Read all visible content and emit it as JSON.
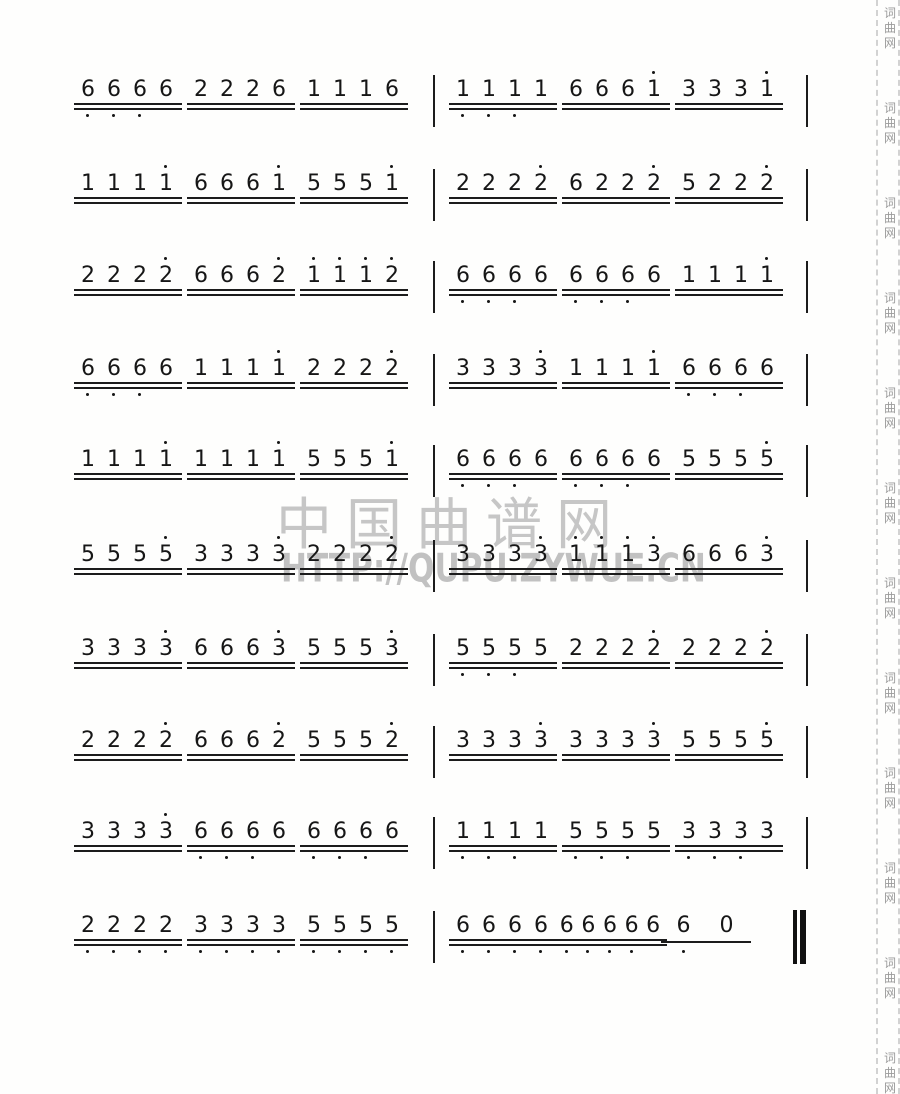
{
  "watermark": {
    "site_name": "中国曲谱网",
    "site_url": "HTTP://QUPU.ZYWUE.CN",
    "color": "#9a9a9a"
  },
  "side_strip": {
    "text": "词曲网",
    "repeat": 12
  },
  "score": {
    "notation_type": "jianpu-numbered-notation",
    "ink_color": "#1c1c1c",
    "rows": [
      {
        "cells": [
          {
            "t": "g",
            "n": "6666",
            "b": [
              0,
              1,
              2
            ]
          },
          {
            "t": "g",
            "n": "2226"
          },
          {
            "t": "g",
            "n": "1116"
          },
          {
            "t": "bar"
          },
          {
            "t": "g",
            "n": "1111",
            "b": [
              0,
              1,
              2
            ]
          },
          {
            "t": "g",
            "n": "6661",
            "a": [
              3
            ]
          },
          {
            "t": "g",
            "n": "3331",
            "a": [
              3
            ]
          },
          {
            "t": "bar"
          }
        ]
      },
      {
        "cells": [
          {
            "t": "g",
            "n": "1111",
            "a": [
              3
            ]
          },
          {
            "t": "g",
            "n": "6661",
            "a": [
              3
            ]
          },
          {
            "t": "g",
            "n": "5551",
            "a": [
              3
            ]
          },
          {
            "t": "bar"
          },
          {
            "t": "g",
            "n": "2222",
            "a": [
              3
            ]
          },
          {
            "t": "g",
            "n": "6222",
            "a": [
              3
            ]
          },
          {
            "t": "g",
            "n": "5222",
            "a": [
              3
            ]
          },
          {
            "t": "bar"
          }
        ]
      },
      {
        "cells": [
          {
            "t": "g",
            "n": "2222",
            "a": [
              3
            ]
          },
          {
            "t": "g",
            "n": "6662",
            "a": [
              3
            ]
          },
          {
            "t": "g",
            "n": "1112",
            "a": [
              0,
              1,
              2,
              3
            ]
          },
          {
            "t": "bar"
          },
          {
            "t": "g",
            "n": "6666",
            "b": [
              0,
              1,
              2
            ]
          },
          {
            "t": "g",
            "n": "6666",
            "b": [
              0,
              1,
              2
            ]
          },
          {
            "t": "g",
            "n": "1111",
            "a": [
              3
            ]
          },
          {
            "t": "bar"
          }
        ]
      },
      {
        "cells": [
          {
            "t": "g",
            "n": "6666",
            "b": [
              0,
              1,
              2
            ]
          },
          {
            "t": "g",
            "n": "1111",
            "a": [
              3
            ]
          },
          {
            "t": "g",
            "n": "2222",
            "a": [
              3
            ]
          },
          {
            "t": "bar"
          },
          {
            "t": "g",
            "n": "3333",
            "a": [
              3
            ]
          },
          {
            "t": "g",
            "n": "1111",
            "a": [
              3
            ]
          },
          {
            "t": "g",
            "n": "6666",
            "b": [
              0,
              1,
              2
            ]
          },
          {
            "t": "bar"
          }
        ]
      },
      {
        "cells": [
          {
            "t": "g",
            "n": "1111",
            "a": [
              3
            ]
          },
          {
            "t": "g",
            "n": "1111",
            "a": [
              3
            ]
          },
          {
            "t": "g",
            "n": "5551",
            "a": [
              3
            ]
          },
          {
            "t": "bar"
          },
          {
            "t": "g",
            "n": "6666",
            "b": [
              0,
              1,
              2
            ]
          },
          {
            "t": "g",
            "n": "6666",
            "b": [
              0,
              1,
              2
            ]
          },
          {
            "t": "g",
            "n": "5555",
            "a": [
              3
            ]
          },
          {
            "t": "bar"
          }
        ]
      },
      {
        "cells": [
          {
            "t": "g",
            "n": "5555",
            "a": [
              3
            ]
          },
          {
            "t": "g",
            "n": "3333",
            "a": [
              3
            ]
          },
          {
            "t": "g",
            "n": "2222",
            "a": [
              3
            ]
          },
          {
            "t": "bar"
          },
          {
            "t": "g",
            "n": "3333",
            "a": [
              3
            ]
          },
          {
            "t": "g",
            "n": "1113",
            "a": [
              0,
              1,
              2,
              3
            ]
          },
          {
            "t": "g",
            "n": "6663",
            "a": [
              3
            ]
          },
          {
            "t": "bar"
          }
        ]
      },
      {
        "cells": [
          {
            "t": "g",
            "n": "3333",
            "a": [
              3
            ]
          },
          {
            "t": "g",
            "n": "6663",
            "a": [
              3
            ]
          },
          {
            "t": "g",
            "n": "5553",
            "a": [
              3
            ]
          },
          {
            "t": "bar"
          },
          {
            "t": "g",
            "n": "5555",
            "b": [
              0,
              1,
              2
            ]
          },
          {
            "t": "g",
            "n": "2222",
            "a": [
              3
            ]
          },
          {
            "t": "g",
            "n": "2222",
            "a": [
              3
            ]
          },
          {
            "t": "bar"
          }
        ]
      },
      {
        "cells": [
          {
            "t": "g",
            "n": "2222",
            "a": [
              3
            ]
          },
          {
            "t": "g",
            "n": "6662",
            "a": [
              3
            ]
          },
          {
            "t": "g",
            "n": "5552",
            "a": [
              3
            ]
          },
          {
            "t": "bar"
          },
          {
            "t": "g",
            "n": "3333",
            "a": [
              3
            ]
          },
          {
            "t": "g",
            "n": "3333",
            "a": [
              3
            ]
          },
          {
            "t": "g",
            "n": "5555",
            "a": [
              3
            ]
          },
          {
            "t": "bar"
          }
        ]
      },
      {
        "cells": [
          {
            "t": "g",
            "n": "3333",
            "a": [
              3
            ]
          },
          {
            "t": "g",
            "n": "6666",
            "b": [
              0,
              1,
              2
            ]
          },
          {
            "t": "g",
            "n": "6666",
            "b": [
              0,
              1,
              2
            ]
          },
          {
            "t": "bar"
          },
          {
            "t": "g",
            "n": "1111",
            "b": [
              0,
              1,
              2
            ]
          },
          {
            "t": "g",
            "n": "5555",
            "b": [
              0,
              1,
              2
            ]
          },
          {
            "t": "g",
            "n": "3333",
            "b": [
              0,
              1,
              2
            ]
          },
          {
            "t": "bar"
          }
        ]
      },
      {
        "cells": [
          {
            "t": "g",
            "n": "2222",
            "b": [
              0,
              1,
              2,
              3
            ]
          },
          {
            "t": "g",
            "n": "3333",
            "b": [
              0,
              1,
              2,
              3
            ]
          },
          {
            "t": "g",
            "n": "5555",
            "b": [
              0,
              1,
              2,
              3
            ]
          },
          {
            "t": "bar"
          },
          {
            "t": "g",
            "n": "6666",
            "b": [
              0,
              1,
              2,
              3
            ]
          },
          {
            "t": "g",
            "n": "66666",
            "b": [
              0,
              1,
              2,
              3
            ],
            "x": 556,
            "w": 108
          },
          {
            "t": "g",
            "n": "60",
            "b": [
              0
            ],
            "beams": 1,
            "spread": true,
            "x": 662,
            "w": 86
          },
          {
            "t": "end",
            "x": 793
          }
        ]
      }
    ]
  }
}
